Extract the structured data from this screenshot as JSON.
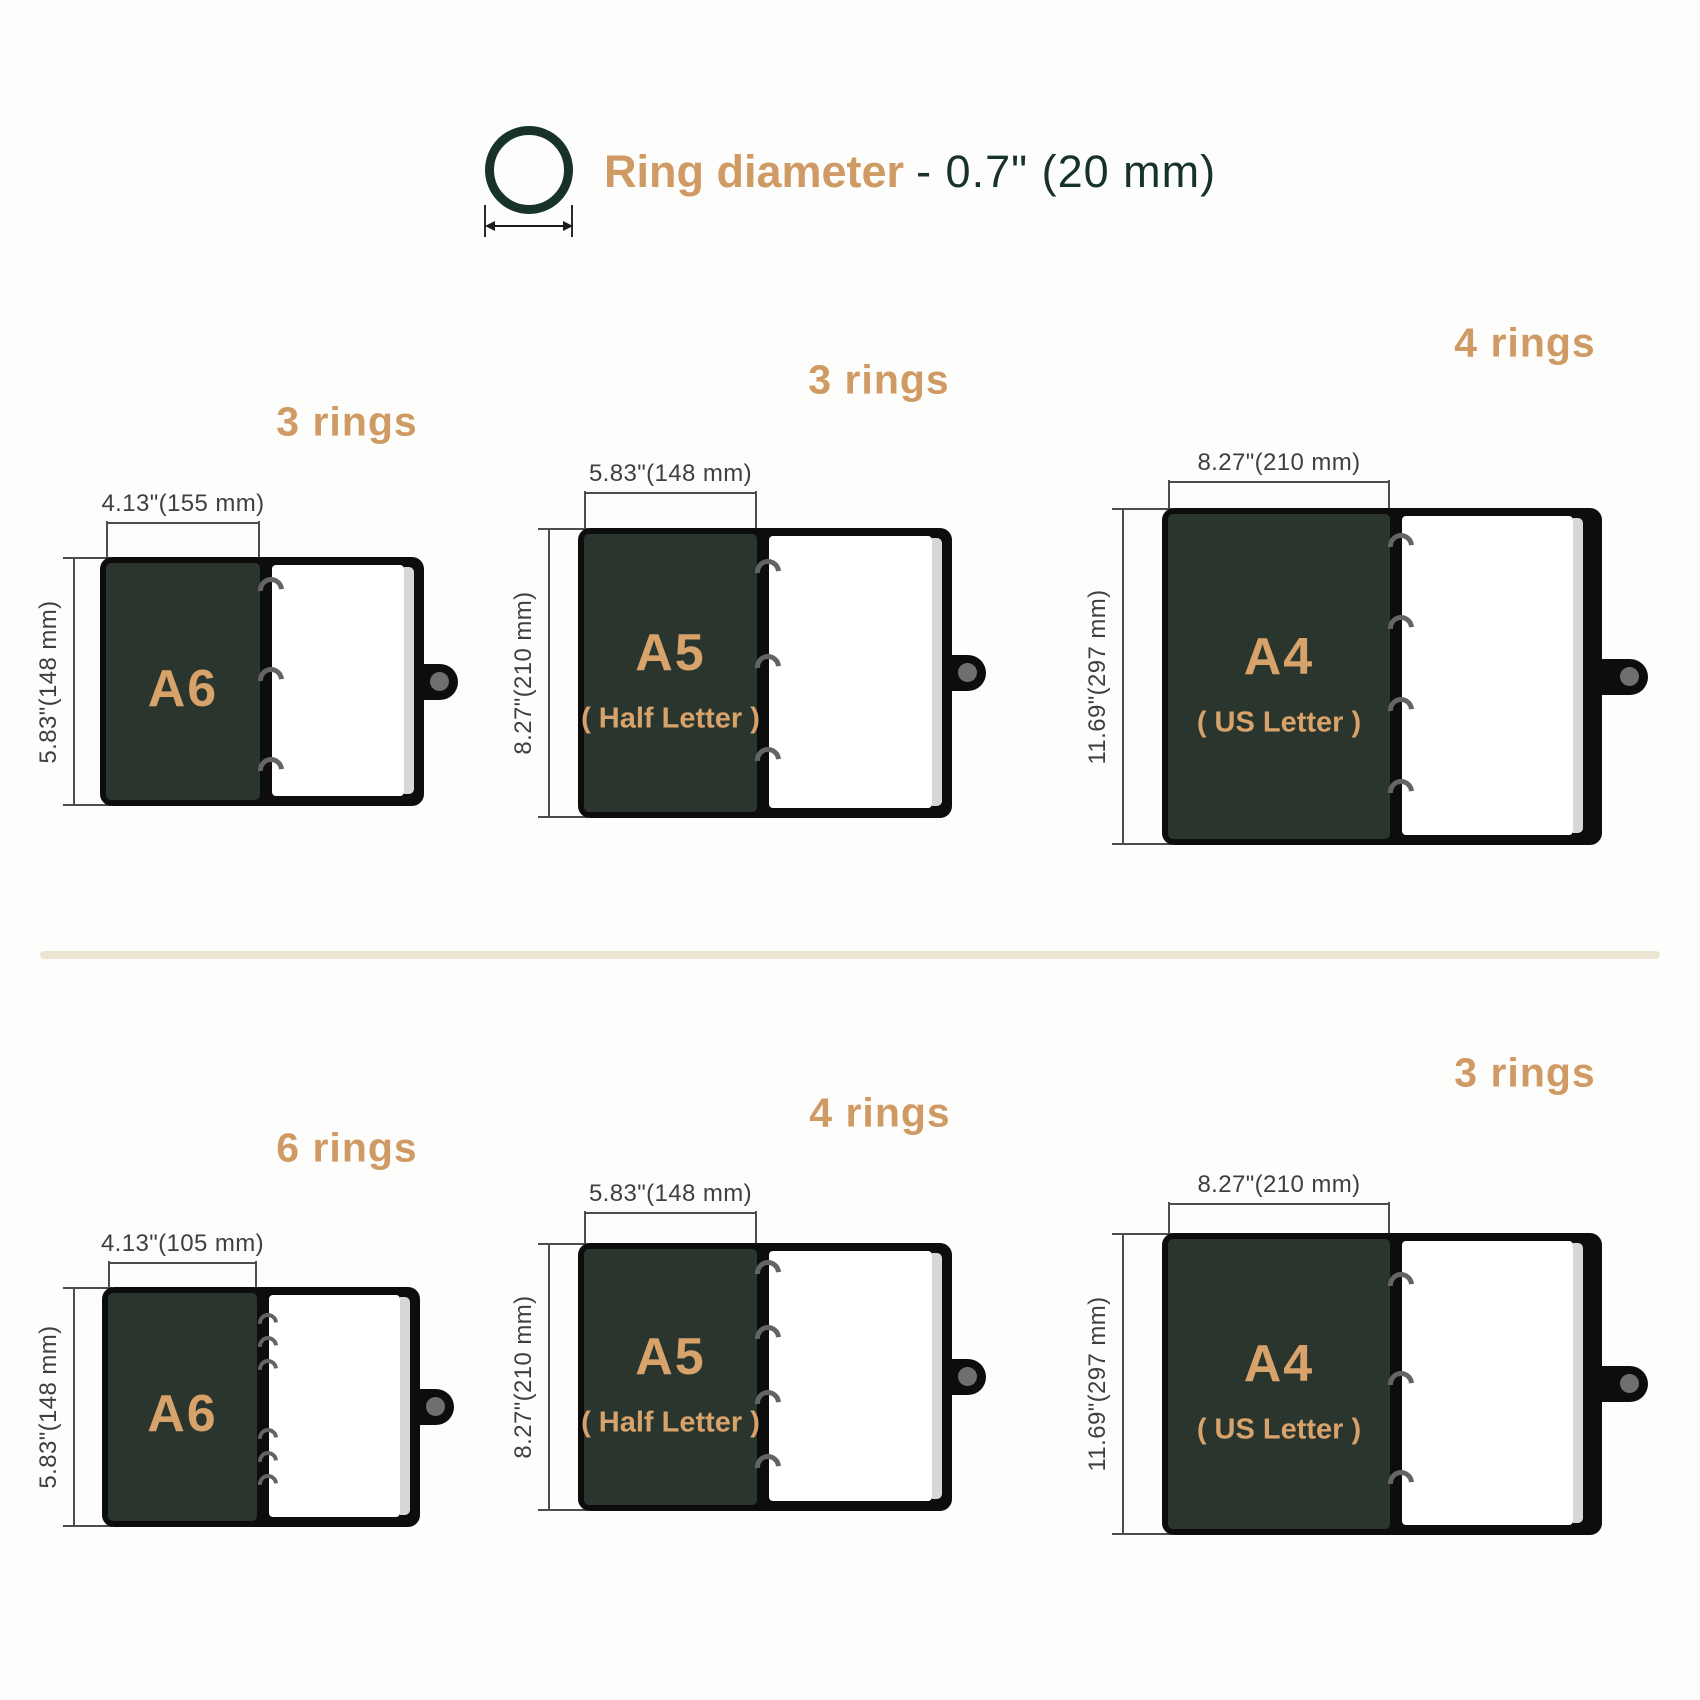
{
  "page": {
    "background": "#fdfdfb"
  },
  "colors": {
    "accent_tan": "#cf9a63",
    "accent_tan_bright": "#d8a26b",
    "dark_green": "#16322a",
    "panel_green": "#2a352d",
    "cover_black": "#0d0d0d",
    "page_white": "#ffffff",
    "page_edge_gray": "#d7d7d5",
    "ring_gray": "#646464",
    "dimension_gray": "#3f3f3f",
    "divider_cream": "#eae5d1"
  },
  "header": {
    "icon": "ring-diameter-icon",
    "label_accent": "Ring diameter",
    "label_value": "- 0.7\" (20 mm)"
  },
  "sections": {
    "top": {
      "binders": [
        {
          "size_label": "A6",
          "subtitle": "",
          "rings_label": "3 rings",
          "ring_count": 3,
          "width_label": "4.13\"(155 mm)",
          "height_label": "5.83\"(148 mm)"
        },
        {
          "size_label": "A5",
          "subtitle": "( Half Letter )",
          "rings_label": "3 rings",
          "ring_count": 3,
          "width_label": "5.83\"(148 mm)",
          "height_label": "8.27\"(210 mm)"
        },
        {
          "size_label": "A4",
          "subtitle": "( US Letter )",
          "rings_label": "4 rings",
          "ring_count": 4,
          "width_label": "8.27\"(210 mm)",
          "height_label": "11.69\"(297 mm)"
        }
      ]
    },
    "bottom": {
      "binders": [
        {
          "size_label": "A6",
          "subtitle": "",
          "rings_label": "6 rings",
          "ring_count": 6,
          "width_label": "4.13\"(105 mm)",
          "height_label": "5.83\"(148 mm)"
        },
        {
          "size_label": "A5",
          "subtitle": "( Half Letter )",
          "rings_label": "4 rings",
          "ring_count": 4,
          "width_label": "5.83\"(148 mm)",
          "height_label": "8.27\"(210 mm)"
        },
        {
          "size_label": "A4",
          "subtitle": "( US Letter )",
          "rings_label": "3 rings",
          "ring_count": 3,
          "width_label": "8.27\"(210 mm)",
          "height_label": "11.69\"(297 mm)"
        }
      ]
    }
  }
}
